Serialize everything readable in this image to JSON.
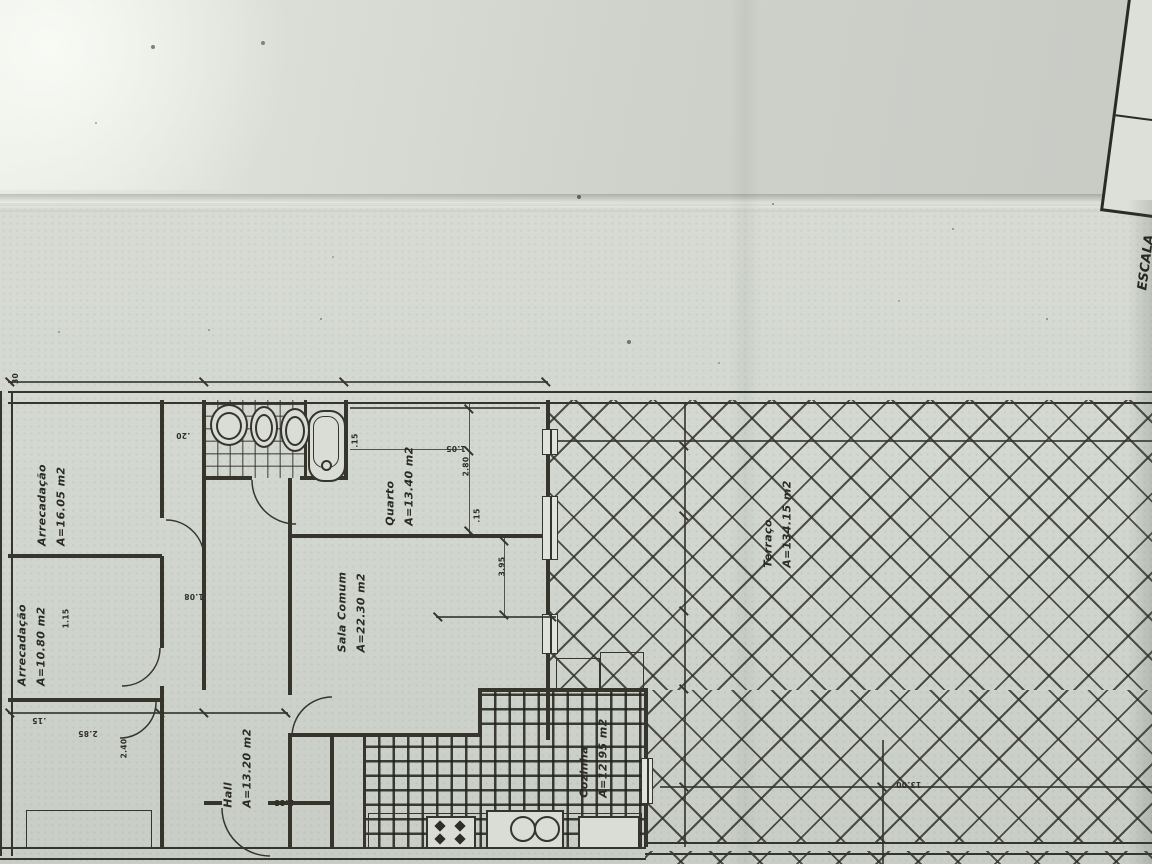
{
  "title_block": {
    "scale_label": "ESCALA",
    "scale_value": "1:100",
    "zone": "Rinchoa Zona"
  },
  "rooms": {
    "arrecadacao_top": {
      "name": "Arrecadação",
      "area": "A=16.05 m2"
    },
    "arrecadacao_mid": {
      "name": "Arrecadação",
      "area": "A=10.80 m2"
    },
    "hall": {
      "name": "Hall",
      "area": "A=13.20 m2"
    },
    "sala_comum": {
      "name": "Sala Comum",
      "area": "A=22.30 m2"
    },
    "quarto": {
      "name": "Quarto",
      "area": "A=13.40 m2"
    },
    "cozinha": {
      "name": "Cozinha",
      "area": "A=12.95 m2"
    },
    "terraco": {
      "name": "Terraço",
      "area": "A=134.15 m2"
    }
  },
  "dimensions": [
    {
      "value": "30"
    },
    {
      "value": ".20"
    },
    {
      "value": "1.05"
    },
    {
      "value": "2.80"
    },
    {
      "value": ".15"
    },
    {
      "value": "3.95"
    },
    {
      "value": "1.08"
    },
    {
      "value": "1.15"
    },
    {
      "value": "2.40"
    },
    {
      "value": ".15"
    },
    {
      "value": "2.85"
    },
    {
      "value": "2.85"
    },
    {
      "value": "13.00"
    },
    {
      "value": ".15"
    }
  ],
  "colors": {
    "ink": "#35352c",
    "paper": "#d2d7cf",
    "paper_top": "#cdd0ca",
    "hatch_line": "#3a3a31"
  }
}
